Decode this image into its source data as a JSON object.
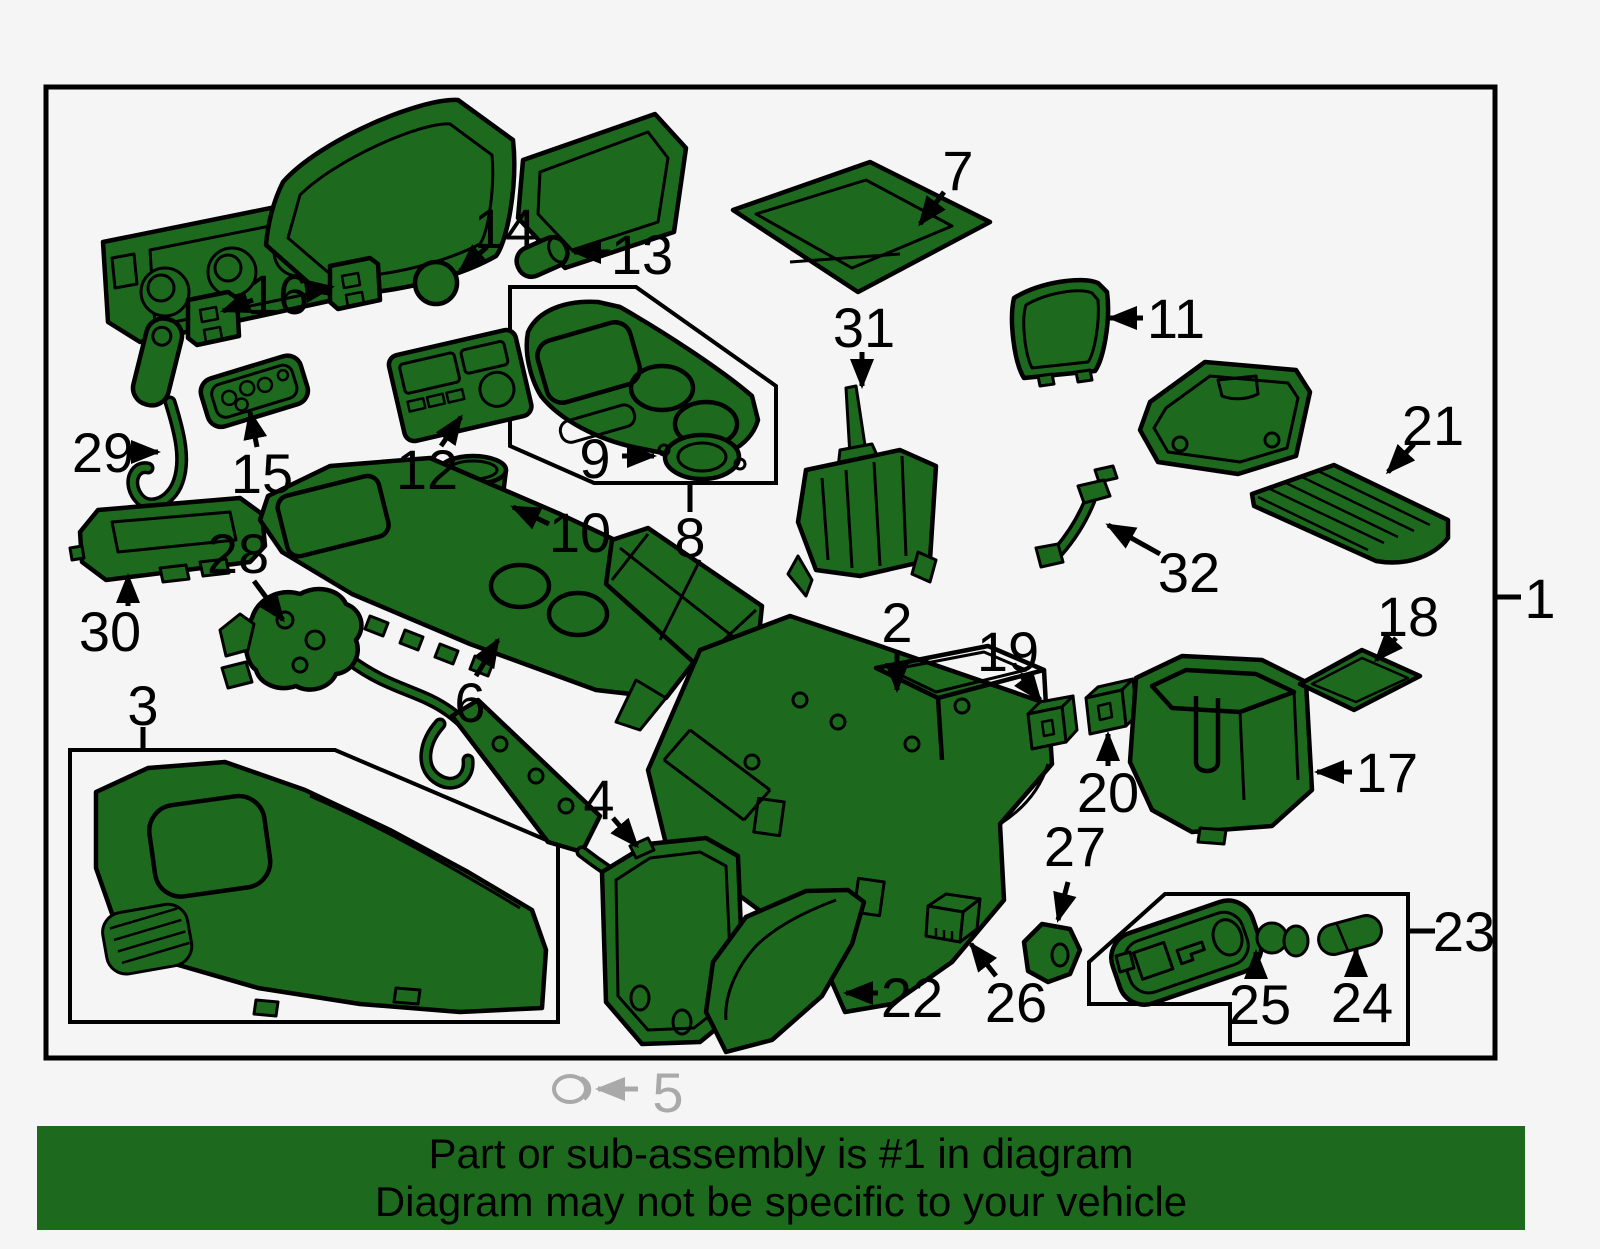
{
  "banner": {
    "line1": "Part or sub-assembly is #1 in diagram",
    "line2": "Diagram may not be specific to your vehicle",
    "background_color": "#1d6a1e",
    "text_color": "#000000"
  },
  "diagram": {
    "background_color": "#f5f5f5",
    "part_fill_color": "#1d6a1e",
    "outline_color": "#000000",
    "callout_text_color": "#000000",
    "footnote_color": "#a9a9a9",
    "callouts": [
      "1",
      "2",
      "3",
      "4",
      "5",
      "6",
      "7",
      "8",
      "9",
      "10",
      "11",
      "12",
      "13",
      "14",
      "15",
      "16",
      "17",
      "18",
      "19",
      "20",
      "21",
      "22",
      "23",
      "24",
      "25",
      "26",
      "27",
      "28",
      "29",
      "30",
      "31",
      "32"
    ]
  }
}
